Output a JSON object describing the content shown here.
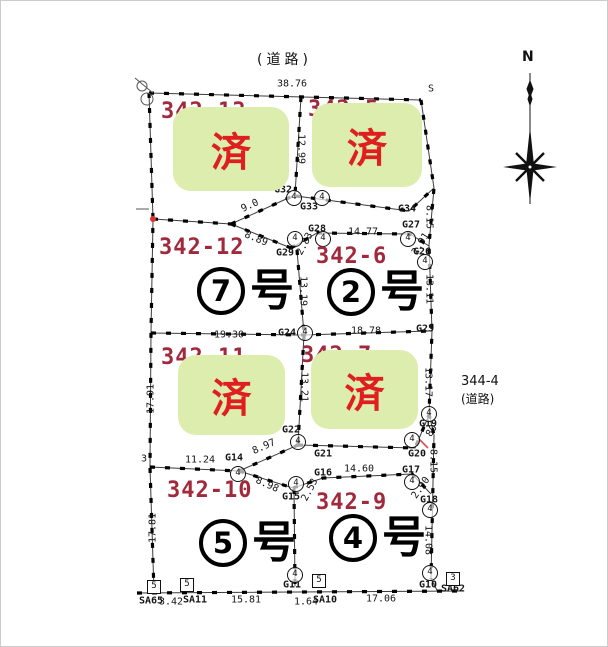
{
  "colors": {
    "badge_bg": "#dcedad",
    "badge_text": "#df1f1f",
    "lot_number": "#a1293c",
    "line": "#1c1c1c"
  },
  "compass": {
    "label": "N"
  },
  "roads": {
    "top_label": "(道路)",
    "right_lot": "344-4",
    "right_label": "(道路)"
  },
  "sold_label": "済",
  "plots": [
    {
      "lot": "342-13",
      "status": "sold"
    },
    {
      "lot": "342-5",
      "status": "sold"
    },
    {
      "lot": "342-12",
      "unit": "7",
      "unit_suffix": "号",
      "status": "available"
    },
    {
      "lot": "342-6",
      "unit": "2",
      "unit_suffix": "号",
      "status": "available"
    },
    {
      "lot": "342-11",
      "status": "sold"
    },
    {
      "lot": "342-7",
      "status": "sold"
    },
    {
      "lot": "342-10",
      "unit": "5",
      "unit_suffix": "号",
      "status": "available"
    },
    {
      "lot": "342-9",
      "unit": "4",
      "unit_suffix": "号",
      "status": "available"
    }
  ],
  "map_annotations": {
    "measurements": [
      {
        "t": "38.76",
        "x": 291,
        "y": 83,
        "r": 0
      },
      {
        "t": "S",
        "x": 430,
        "y": 88,
        "r": 0
      },
      {
        "t": "12.99",
        "x": 300,
        "y": 148,
        "r": 90
      },
      {
        "t": "9.0",
        "x": 249,
        "y": 205,
        "r": -24
      },
      {
        "t": "8.89",
        "x": 255,
        "y": 238,
        "r": 22
      },
      {
        "t": "2.83",
        "x": 304,
        "y": 243,
        "r": -62
      },
      {
        "t": "14.77",
        "x": 362,
        "y": 231,
        "r": 0
      },
      {
        "t": "2.91",
        "x": 420,
        "y": 243,
        "r": -58
      },
      {
        "t": "8.15",
        "x": 428,
        "y": 216,
        "r": 90
      },
      {
        "t": "13.19",
        "x": 302,
        "y": 290,
        "r": 90
      },
      {
        "t": "13.11",
        "x": 428,
        "y": 288,
        "r": 90
      },
      {
        "t": "19.30",
        "x": 228,
        "y": 334,
        "r": 0
      },
      {
        "t": "18.78",
        "x": 365,
        "y": 330,
        "r": 0
      },
      {
        "t": "13.21",
        "x": 303,
        "y": 386,
        "r": 90
      },
      {
        "t": "13.17",
        "x": 427,
        "y": 381,
        "r": 90
      },
      {
        "t": "8.97",
        "x": 263,
        "y": 446,
        "r": -24
      },
      {
        "t": "11.24",
        "x": 199,
        "y": 459,
        "r": 0
      },
      {
        "t": "8.98",
        "x": 266,
        "y": 484,
        "r": 24
      },
      {
        "t": "2.53",
        "x": 309,
        "y": 489,
        "r": -62
      },
      {
        "t": "80",
        "x": 431,
        "y": 430,
        "r": -58
      },
      {
        "t": "8.15",
        "x": 432,
        "y": 460,
        "r": 90
      },
      {
        "t": "14.60",
        "x": 358,
        "y": 468,
        "r": 0
      },
      {
        "t": "2.90",
        "x": 420,
        "y": 487,
        "r": -55
      },
      {
        "t": "14.08",
        "x": 427,
        "y": 539,
        "r": 90
      },
      {
        "t": "17.91",
        "x": 150,
        "y": 398,
        "r": -90
      },
      {
        "t": "17.81",
        "x": 152,
        "y": 527,
        "r": -90
      },
      {
        "t": "3",
        "x": 143,
        "y": 458,
        "r": 0
      },
      {
        "t": "3.42",
        "x": 170,
        "y": 601,
        "r": 0
      },
      {
        "t": "15.81",
        "x": 245,
        "y": 599,
        "r": 0
      },
      {
        "t": "1.64",
        "x": 305,
        "y": 601,
        "r": 0
      },
      {
        "t": "17.06",
        "x": 380,
        "y": 598,
        "r": 0
      }
    ],
    "point_labels": [
      {
        "t": "G32",
        "x": 282,
        "y": 189
      },
      {
        "t": "G33",
        "x": 308,
        "y": 206
      },
      {
        "t": "G34",
        "x": 406,
        "y": 208
      },
      {
        "t": "G27",
        "x": 410,
        "y": 224
      },
      {
        "t": "G28",
        "x": 316,
        "y": 228
      },
      {
        "t": "G29",
        "x": 284,
        "y": 252
      },
      {
        "t": "G26",
        "x": 421,
        "y": 251
      },
      {
        "t": "G24",
        "x": 286,
        "y": 332
      },
      {
        "t": "G25",
        "x": 424,
        "y": 328
      },
      {
        "t": "G22",
        "x": 290,
        "y": 429
      },
      {
        "t": "G14",
        "x": 233,
        "y": 457
      },
      {
        "t": "G21",
        "x": 322,
        "y": 453
      },
      {
        "t": "G19",
        "x": 427,
        "y": 423
      },
      {
        "t": "G20",
        "x": 416,
        "y": 453
      },
      {
        "t": "G16",
        "x": 322,
        "y": 472
      },
      {
        "t": "G17",
        "x": 410,
        "y": 469
      },
      {
        "t": "G15",
        "x": 290,
        "y": 496
      },
      {
        "t": "G18",
        "x": 428,
        "y": 499
      },
      {
        "t": "G11",
        "x": 291,
        "y": 584
      },
      {
        "t": "G10",
        "x": 427,
        "y": 584
      },
      {
        "t": "SA65",
        "x": 150,
        "y": 600
      },
      {
        "t": "SA11",
        "x": 194,
        "y": 599
      },
      {
        "t": "SA10",
        "x": 324,
        "y": 599
      },
      {
        "t": "SA62",
        "x": 452,
        "y": 588
      }
    ],
    "circle_marker_label": "4",
    "circle_markers": [
      {
        "x": 293,
        "y": 197
      },
      {
        "x": 321,
        "y": 197
      },
      {
        "x": 294,
        "y": 238
      },
      {
        "x": 322,
        "y": 238
      },
      {
        "x": 407,
        "y": 238
      },
      {
        "x": 424,
        "y": 261
      },
      {
        "x": 304,
        "y": 332
      },
      {
        "x": 297,
        "y": 441
      },
      {
        "x": 237,
        "y": 473
      },
      {
        "x": 411,
        "y": 439
      },
      {
        "x": 428,
        "y": 413
      },
      {
        "x": 295,
        "y": 483
      },
      {
        "x": 411,
        "y": 481
      },
      {
        "x": 429,
        "y": 509
      },
      {
        "x": 294,
        "y": 574
      },
      {
        "x": 429,
        "y": 572
      }
    ],
    "square_markers": [
      {
        "t": "5",
        "x": 153,
        "y": 586
      },
      {
        "t": "5",
        "x": 186,
        "y": 584
      },
      {
        "t": "5",
        "x": 318,
        "y": 580
      },
      {
        "t": "3",
        "x": 452,
        "y": 578
      }
    ]
  }
}
